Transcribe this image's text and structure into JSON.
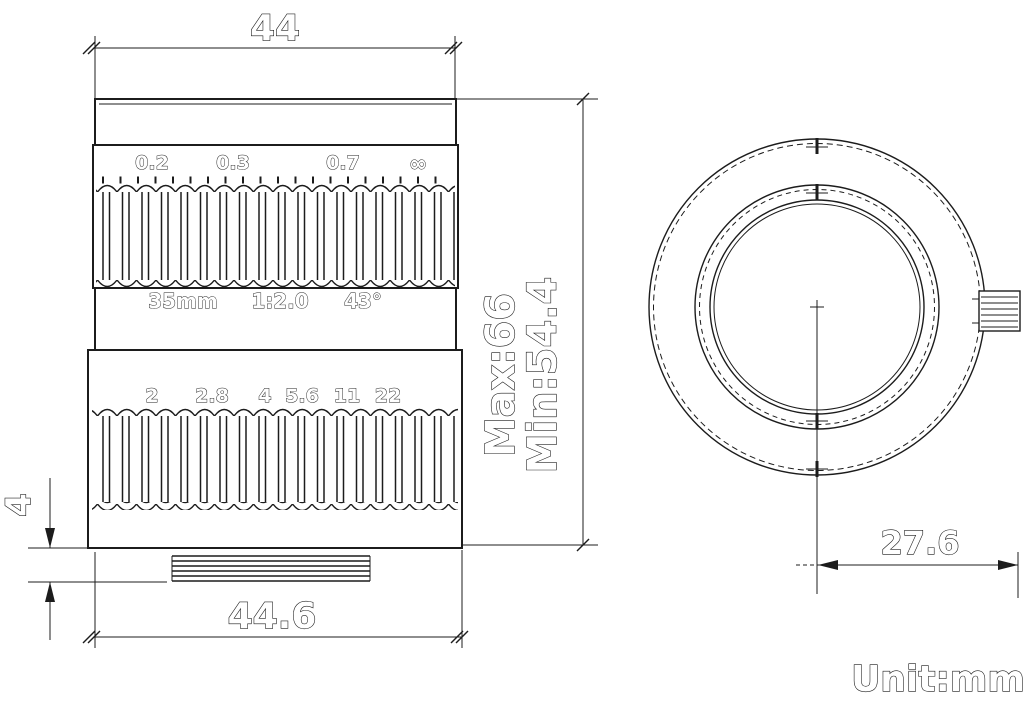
{
  "side_view": {
    "dim_top_width": "44",
    "dim_bottom_width": "44.6",
    "dim_thread_length": "4",
    "dim_length_max": "Max:66",
    "dim_length_min": "Min:54.4",
    "focus_scale": [
      "0.2",
      "0.3",
      "0.7",
      "∞"
    ],
    "spec_focal_length": "35mm",
    "spec_aperture": "1:2.0",
    "spec_angle": "43°",
    "aperture_scale": [
      "2",
      "2.8",
      "4",
      "5.6",
      "11",
      "22"
    ]
  },
  "front_view": {
    "dim_center_to_screw": "27.6"
  },
  "footer": {
    "unit_label": "Unit:mm"
  },
  "colors": {
    "line": "#1c1c1c",
    "background": "#ffffff"
  }
}
